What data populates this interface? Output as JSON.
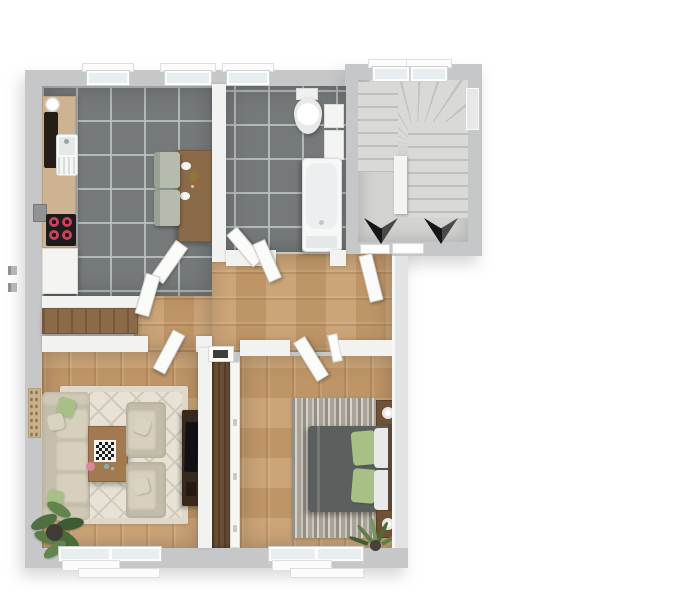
{
  "meta": {
    "title": "3D apartment floor plan, top-down view",
    "view": "top-down 3d render",
    "visible_text": "none"
  },
  "palette": {
    "background": "#ffffff",
    "exterior_wall": "#c6c7c9",
    "interior_wall": "#f2f2f1",
    "tile_floor": "#75797a",
    "tile_grout": "#b9bfbf",
    "wood_floor": "#c79d6d",
    "stair_floor": "#d3d3d1",
    "rug_living": "#e7e2d5",
    "rug_bedroom": "#b5b0a5",
    "sofa_beige": "#cfc8b6",
    "bed_gray": "#5b5f5e",
    "pillow_green": "#a8bf85",
    "pillow_white": "#e9e9e7",
    "furniture_wood": "#8a6a48",
    "wardrobe_wood": "#6b4f36",
    "tv_console_dark": "#38291c",
    "cooktop_black": "#1c1c1c",
    "burner_red": "#c2455a",
    "arrow_black": "#161616",
    "plant_green": "#55753f",
    "window_glass": "#e8edf0"
  },
  "rooms": [
    {
      "id": "kitchen",
      "label": "Kitchen",
      "floor": "gray tile",
      "contents": [
        "counter with sink and drainboard",
        "water heater",
        "tall dark appliance",
        "cooktop with 4 burners",
        "wall box",
        "base cabinet",
        "dining table with 2 plates and food",
        "2 sage-green chairs",
        "2 windows"
      ]
    },
    {
      "id": "bathroom",
      "label": "Bathroom",
      "floor": "gray tile",
      "contents": [
        "toilet with tank",
        "washbasin cabinet",
        "bathtub with drain",
        "window"
      ]
    },
    {
      "id": "stairwell",
      "label": "Stairwell",
      "floor": "concrete",
      "contents": [
        "winder staircase",
        "center divider",
        "2 black down arrows",
        "2 top windows",
        "side window",
        "entry threshold"
      ]
    },
    {
      "id": "hallway",
      "label": "Hallway",
      "floor": "wood planks",
      "contents": [
        "sideboard with wood top",
        "open white doors"
      ]
    },
    {
      "id": "living_room",
      "label": "Living room",
      "floor": "wood planks",
      "contents": [
        "diamond-pattern beige rug",
        "3-seat sofa with green pillows",
        "2 armchairs with pillows",
        "coffee table with chessboard",
        "pink bowl",
        "tv console with tv",
        "potted plant",
        "wall picture"
      ]
    },
    {
      "id": "bedroom",
      "label": "Bedroom",
      "floor": "wood planks",
      "contents": [
        "striped gray rug",
        "double bed with gray duvet",
        "2 green pillows",
        "2 white pillows",
        "2 nightstands with round lamps",
        "tall wardrobe with white doors and vent",
        "potted plant"
      ]
    }
  ],
  "stairs": {
    "direction_arrows": [
      "down",
      "down"
    ]
  },
  "openings": {
    "doors": [
      "kitchen door",
      "kitchen second leaf",
      "bathroom door leaf a",
      "bathroom door leaf b",
      "apartment entry door",
      "bedroom door",
      "living room door"
    ],
    "windows": [
      "kitchen window 1",
      "kitchen window 2",
      "bathroom window",
      "stairwell window 1",
      "stairwell window 2",
      "stairwell side window",
      "living room window",
      "bedroom window"
    ]
  }
}
